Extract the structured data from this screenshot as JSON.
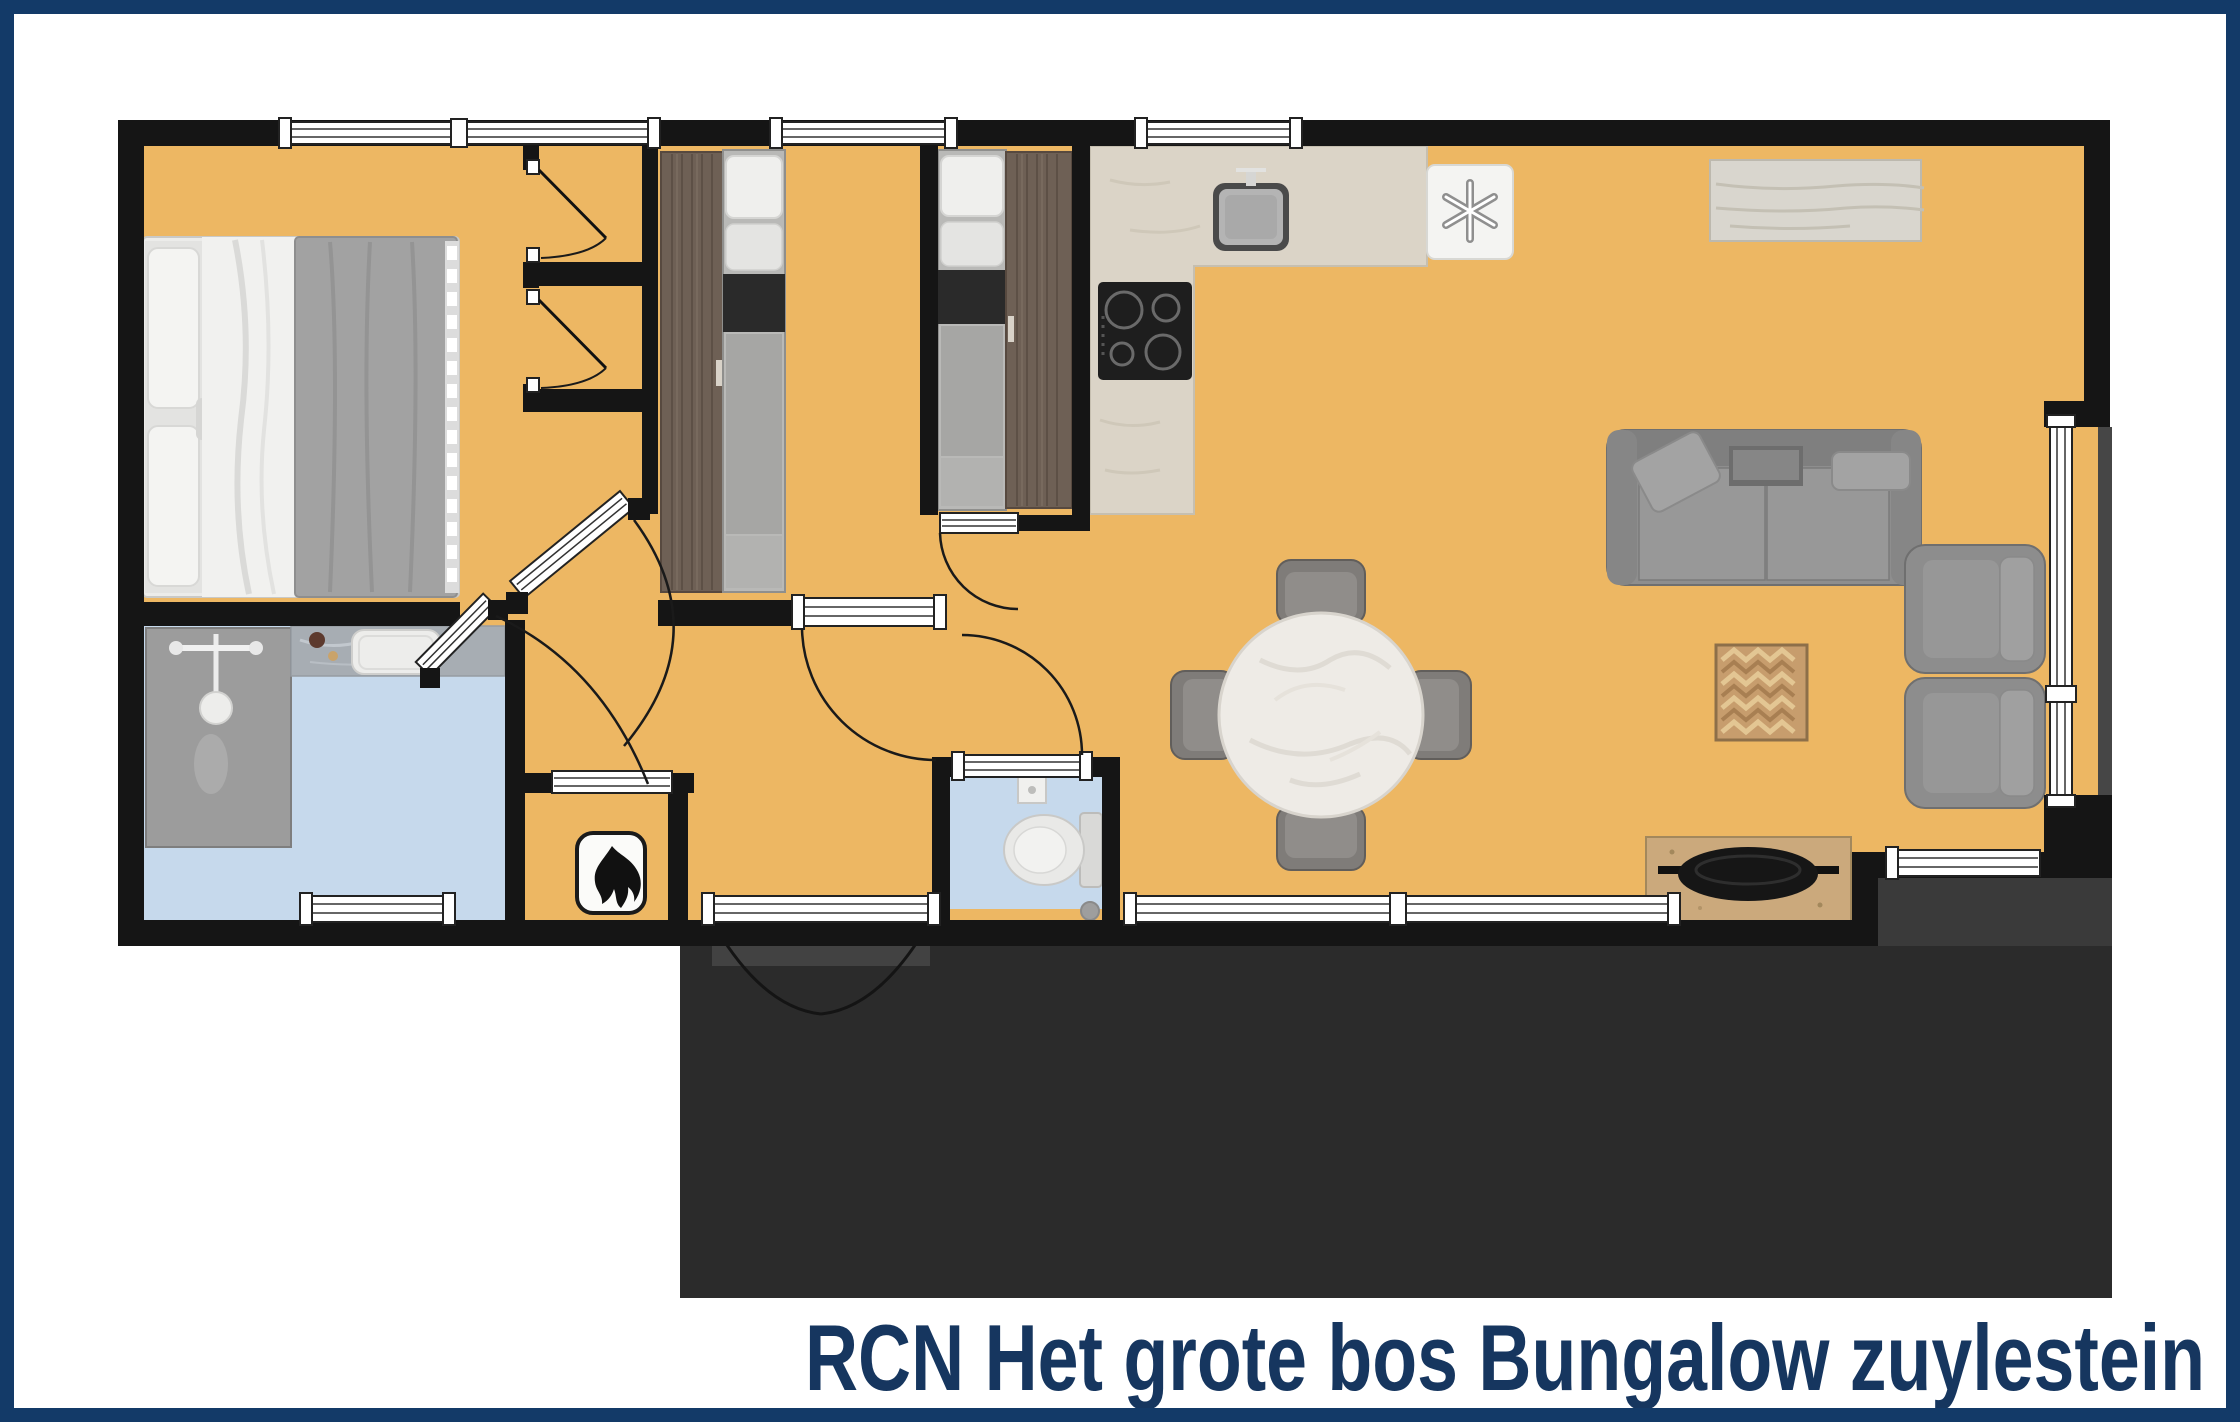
{
  "title": {
    "text": "RCN Het grote bos Bungalow zuylestein",
    "color": "#16365f"
  },
  "floorplan": {
    "type": "bungalow-floor-plan-top-view",
    "rooms": [
      {
        "name": "master-bedroom"
      },
      {
        "name": "closet-top"
      },
      {
        "name": "closet-bottom"
      },
      {
        "name": "bedroom-2"
      },
      {
        "name": "bedroom-3"
      },
      {
        "name": "kitchen"
      },
      {
        "name": "dining-area"
      },
      {
        "name": "living-room"
      },
      {
        "name": "hallway"
      },
      {
        "name": "bathroom"
      },
      {
        "name": "toilet"
      },
      {
        "name": "boiler-closet"
      },
      {
        "name": "porch"
      },
      {
        "name": "terrace"
      }
    ],
    "furniture": [
      "double-bed",
      "single-bed",
      "single-bed",
      "wardrobe",
      "wardrobe",
      "kitchen-counter",
      "sink",
      "cooktop",
      "fridge-freezer",
      "sideboard",
      "sofa",
      "armchair",
      "armchair",
      "side-table",
      "tv-cabinet",
      "round-dining-table",
      "dining-chair",
      "dining-chair",
      "dining-chair",
      "dining-chair",
      "shower",
      "vanity-sink",
      "toilet-bowl",
      "corner-sink",
      "central-heating-boiler"
    ],
    "colors": {
      "frame": "#133a68",
      "floor": "#edb763",
      "walls": "#151515",
      "wet-room-floor": "#c6d9ec",
      "terrace": "#2b2b2b",
      "terrace-light": "#424242",
      "counter": "#dbd4c7",
      "wardrobe-wood": "#6e6055",
      "cabinet-wood": "#cba97c",
      "sofa-gray": "#8e8e8e",
      "title": "#16365f"
    }
  }
}
